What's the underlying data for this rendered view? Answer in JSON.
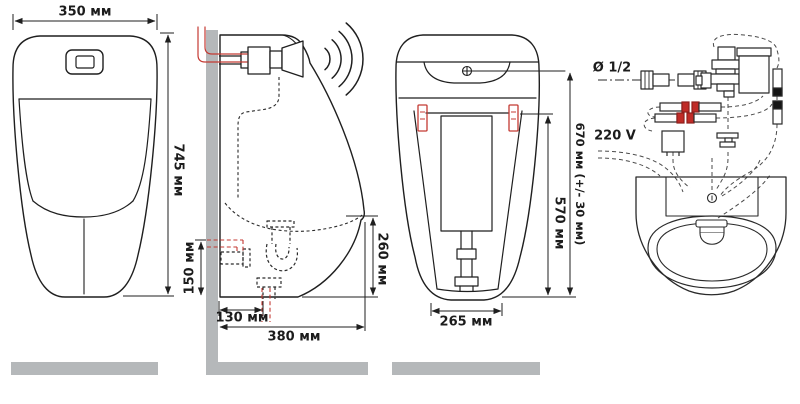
{
  "document": {
    "type": "technical-installation-diagram",
    "subject": "sensor urinal with mounting dimensions and installation schematic"
  },
  "colors": {
    "line": "#1f1f1f",
    "accent_red": "#c43a33",
    "surface_gray": "#b5b8ba",
    "background": "#ffffff"
  },
  "panels": {
    "front_view": {
      "dims": {
        "top_width": "350 мм",
        "total_height": "745 мм"
      }
    },
    "side_view": {
      "dims": {
        "drain_inlet_height": "150 мм",
        "drain_wall_offset": "130 мм",
        "total_depth": "380 мм",
        "underside_height": "260 мм"
      }
    },
    "rear_view": {
      "dims": {
        "top_fixing_height": "670 мм (+/- 30 мм)",
        "bracket_height": "570 мм",
        "base_width": "265 мм"
      }
    },
    "installation_schematic": {
      "labels": {
        "water_supply": "Ø 1/2",
        "power_supply": "220 V"
      }
    }
  }
}
